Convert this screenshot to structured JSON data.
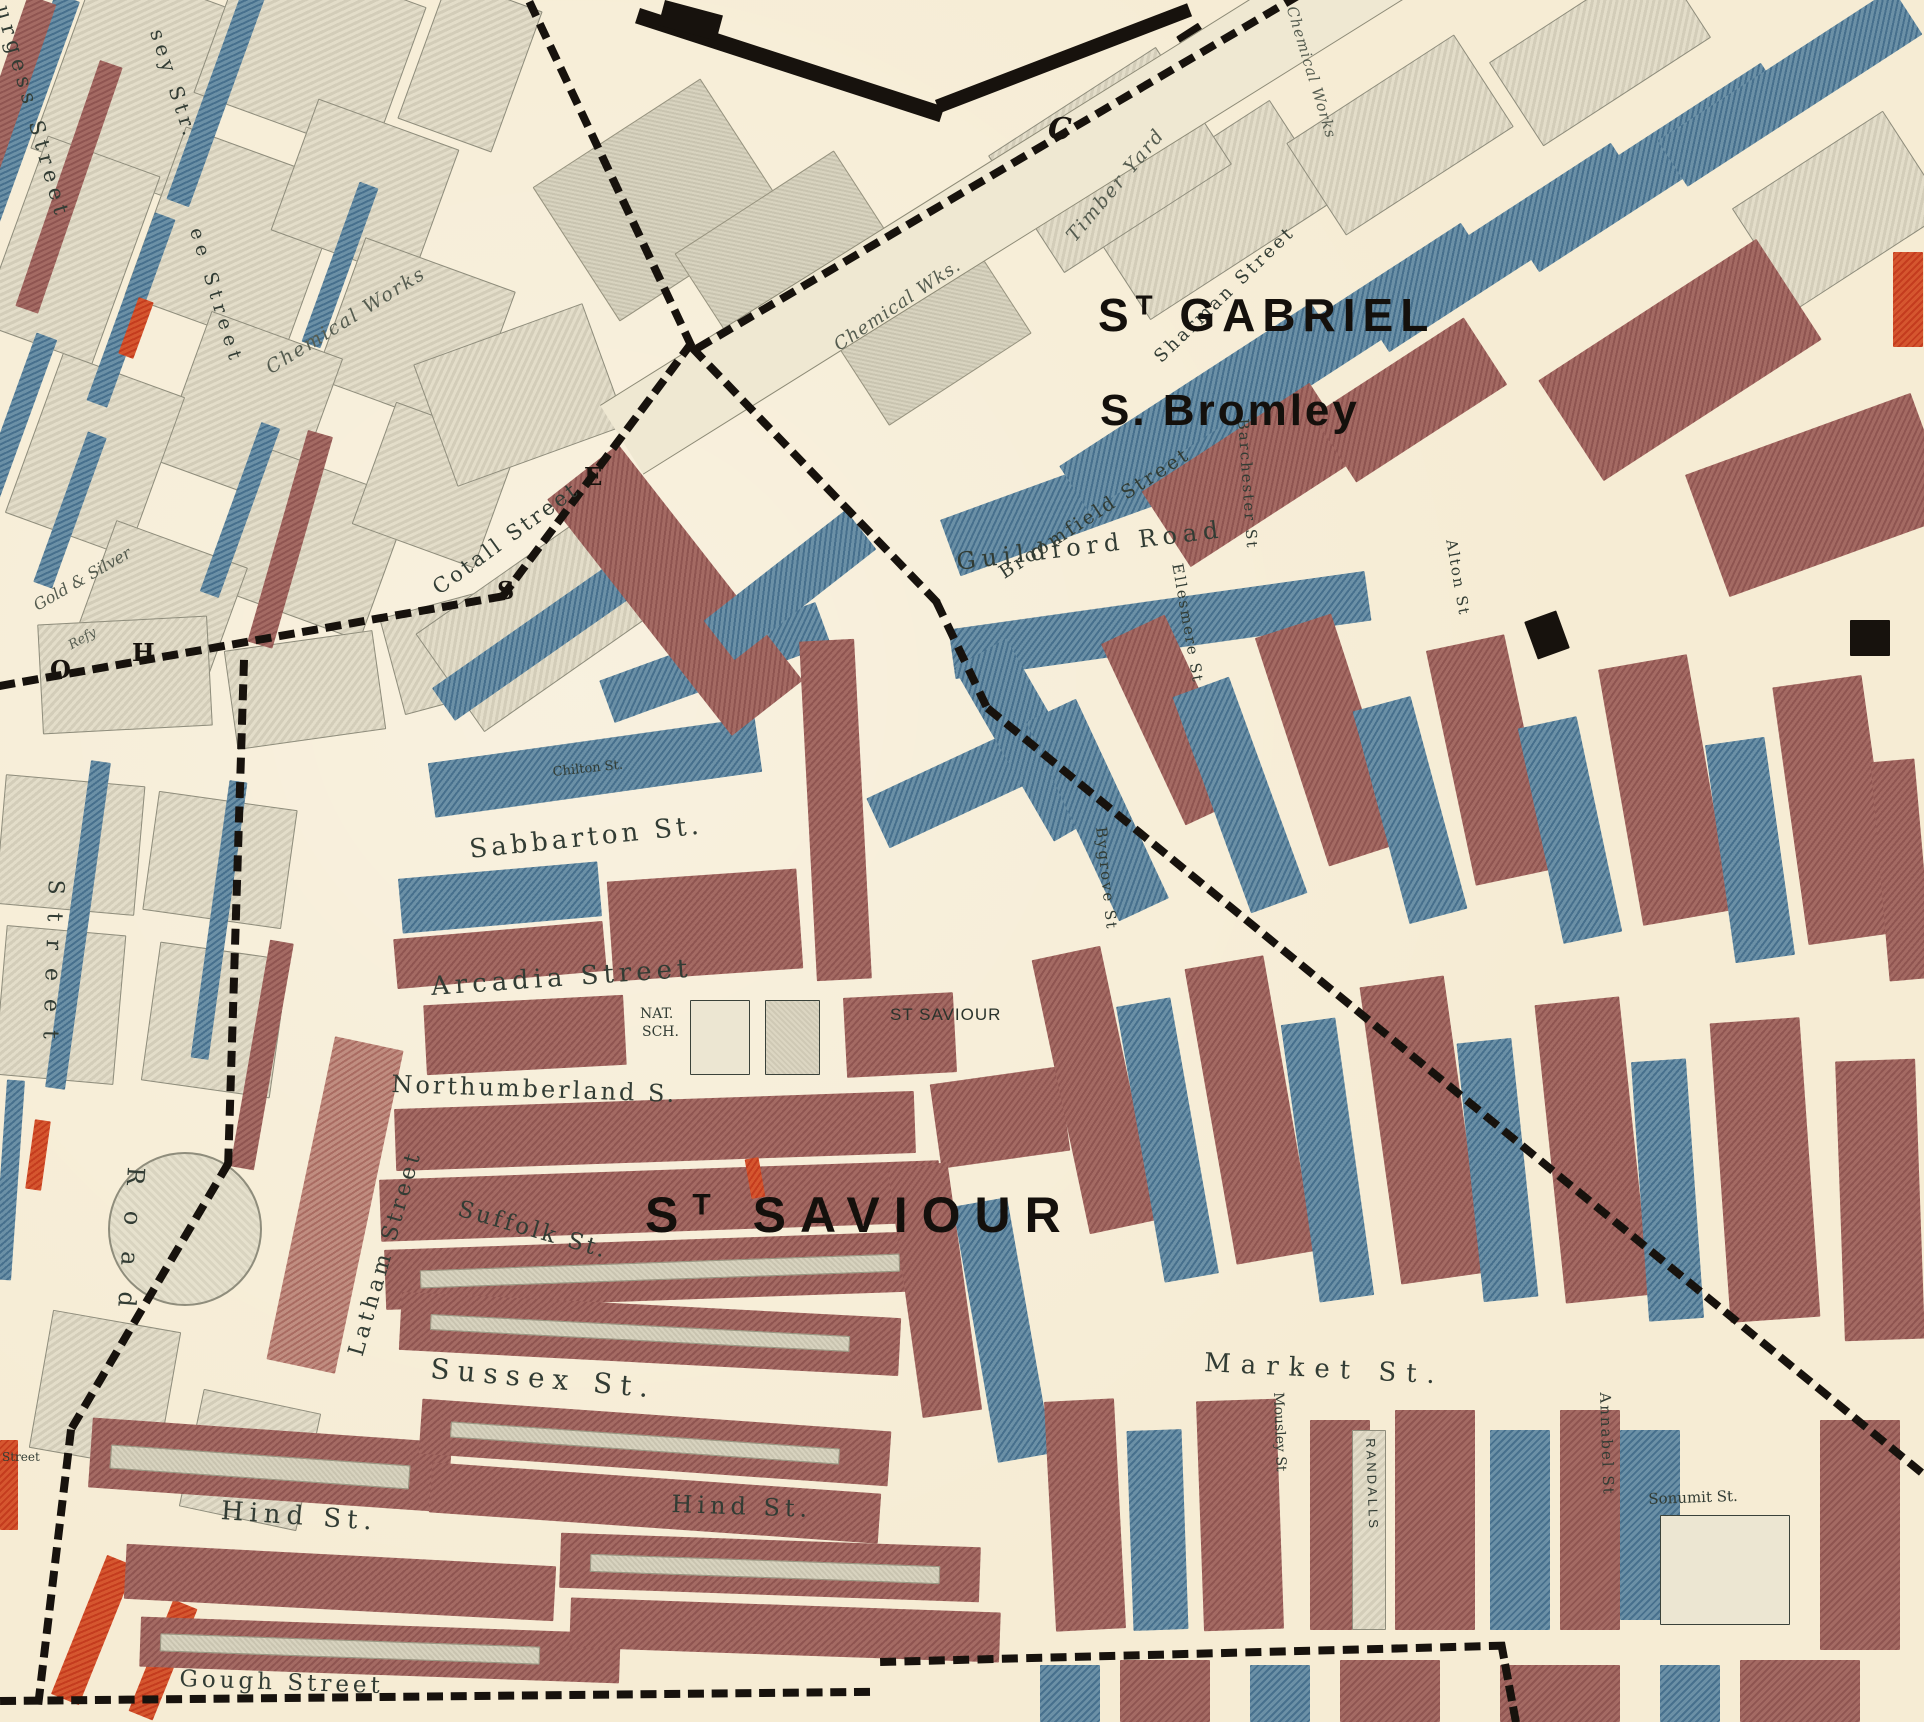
{
  "map": {
    "districts": {
      "st_gabriel": {
        "prefix": "S",
        "sup": "T",
        "name": "GABRIEL"
      },
      "s_bromley": "S. Bromley",
      "st_saviour": {
        "prefix": "S",
        "sup": "T",
        "name": "SAVIOUR"
      }
    },
    "streets": {
      "burgess": "Burgess Street",
      "sey": "sey Str.",
      "ee": "ee Street",
      "cotall": "Cotall Street",
      "chilton": "Chilton St.",
      "sabbarton": "Sabbarton St.",
      "arcadia": "Arcadia Street",
      "northumberland": "Northumberland S.",
      "latham": "Latham Street",
      "suffolk": "Suffolk St.",
      "sussex": "Sussex St.",
      "hind_west": "Hind St.",
      "hind_east": "Hind St.",
      "gough": "Gough Street",
      "road": "Road",
      "street_frag": "Street",
      "street_frag2": "Street",
      "sharman": "Sharman Street",
      "broomfield": "Broomfield Street",
      "guildford": "Guildford Road",
      "market": "Market St.",
      "annabel": "Annabel St",
      "sonumit": "Sonumit St.",
      "mousley": "Mousley St",
      "barchester": "Barchester St",
      "ellesmere": "Ellesmere St",
      "bygrove": "Bygrove St",
      "alton": "Alton St"
    },
    "places": {
      "chemical_works_west": "Chemical Works",
      "chemical_wks": "Chemical Wks.",
      "chemical_works_ne": "Chemical Works",
      "timber_yard": "Timber Yard",
      "gold_silver": "Gold & Silver",
      "refinery": "Refy",
      "nat_line1": "NAT.",
      "nat_line2": "SCH.",
      "st_saviour_church": "ST SAVIOUR",
      "randalls": "RANDALLS"
    },
    "boundary_letters": {
      "c": "C",
      "s": "S",
      "e": "E",
      "h": "H",
      "o": "O"
    },
    "colors": {
      "well_to_do_red": "#9a5f58",
      "poverty_blue": "#4a7390",
      "bright_red": "#c6401f",
      "background_cream": "#f6ecd4",
      "boundary_black": "#17120d"
    }
  }
}
